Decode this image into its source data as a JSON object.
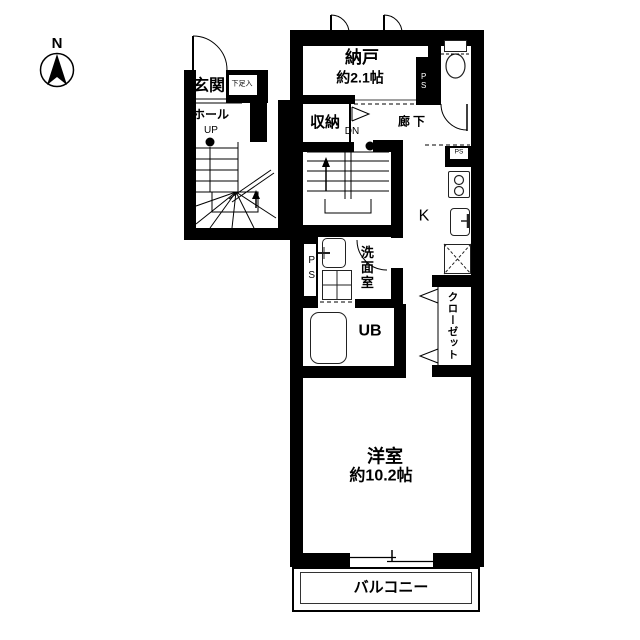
{
  "compass": {
    "north": "N"
  },
  "floor1_entrance": {
    "genkan": "玄関",
    "shoebox": "下足入",
    "hall": "ホール",
    "up": "UP"
  },
  "floor2": {
    "nando": "納戸",
    "nando_size": "約2.1帖",
    "ps_duct_top": "PS",
    "ps_duct_corner": "PS",
    "ps_duct_mid": "PS",
    "shuno": "収納",
    "corridor": "廊下",
    "down": "DN",
    "kitchen": "K",
    "washroom": "洗面室",
    "unit_bath": "UB",
    "closet": "クローゼット",
    "main_room": "洋室",
    "main_room_size": "約10.2帖",
    "balcony": "バルコニー"
  }
}
